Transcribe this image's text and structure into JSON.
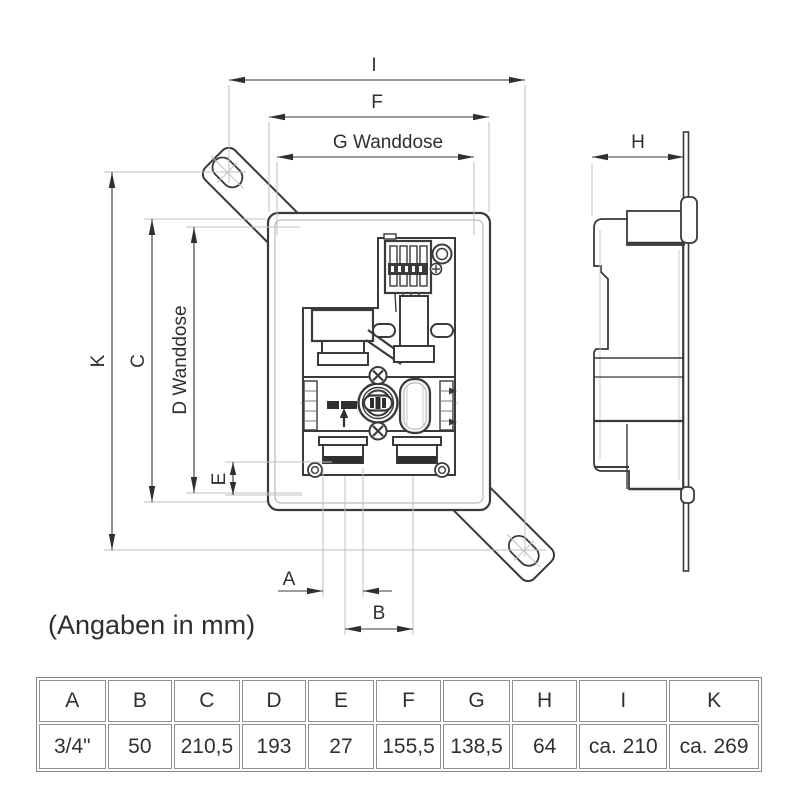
{
  "note": "(Angaben in mm)",
  "drawing": {
    "dimension_labels": {
      "I": "I",
      "F": "F",
      "G": "G Wanddose",
      "H": "H",
      "K": "K",
      "C": "C",
      "D": "D Wanddose",
      "E": "E",
      "A": "A",
      "B": "B"
    }
  },
  "table": {
    "headers": [
      "A",
      "B",
      "C",
      "D",
      "E",
      "F",
      "G",
      "H",
      "I",
      "K"
    ],
    "values": [
      "3/4\"",
      "50",
      "210,5",
      "193",
      "27",
      "155,5",
      "138,5",
      "64",
      "ca. 210",
      "ca. 269"
    ]
  },
  "colors": {
    "line": "#3a3a3c",
    "light_line": "#c0c0c3",
    "text": "#2f2f31",
    "table_border": "#8a8a8a"
  }
}
